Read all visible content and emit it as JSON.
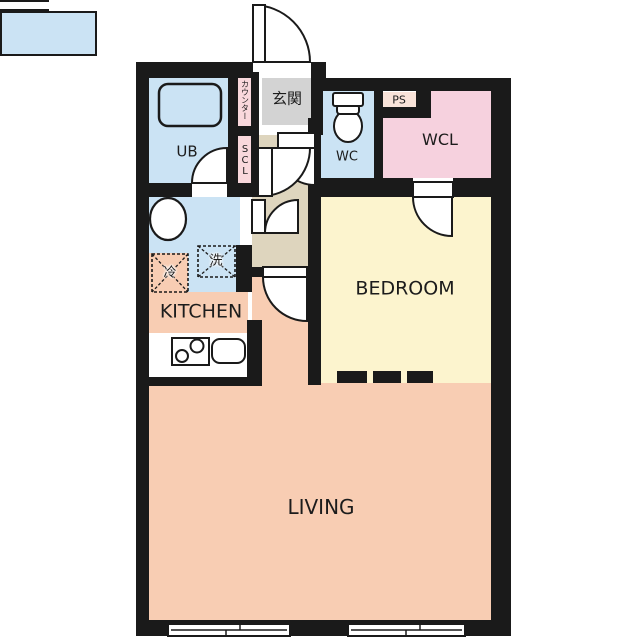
{
  "rooms": {
    "ub": {
      "label": "UB"
    },
    "counter": {
      "label": "カウンター"
    },
    "scl": {
      "label": "SCL"
    },
    "genkan": {
      "label": "玄関"
    },
    "wc": {
      "label": "WC"
    },
    "ps": {
      "label": "PS"
    },
    "wcl": {
      "label": "WCL"
    },
    "bedroom": {
      "label": "BEDROOM"
    },
    "kitchen": {
      "label": "KITCHEN"
    },
    "living": {
      "label": "LIVING"
    }
  },
  "fixtures": {
    "fridge": {
      "label": "冷"
    },
    "washer": {
      "label": "洗"
    }
  },
  "colors": {
    "wall": "#1a1a1a",
    "wet_area_blue": "#cbe3f4",
    "closet_strip_pink": "#f9d8dc",
    "entry_gray": "#d3d3d3",
    "hall_beige": "#ded5be",
    "wcl_pink": "#f6d1de",
    "ps_pink": "#f9e3d9",
    "bedroom_yellow": "#fcf4ce",
    "living_salmon": "#f8cdb3"
  }
}
